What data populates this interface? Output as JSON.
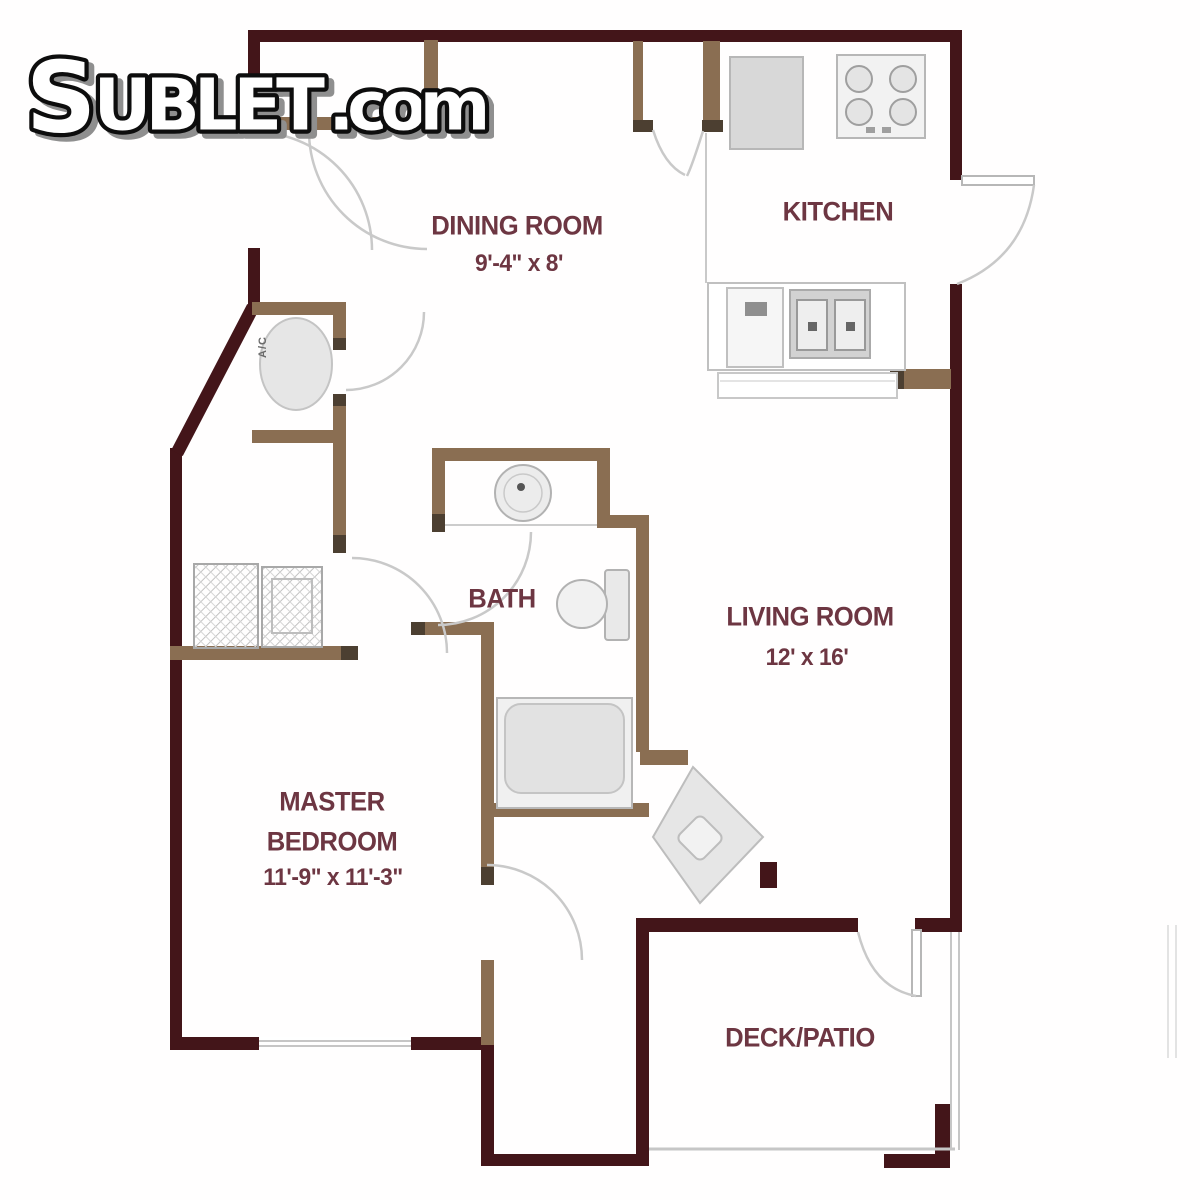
{
  "logo": {
    "s": "S",
    "ublet": "UBLET",
    "dotcom": ".com",
    "full_text": "SUBLET.com"
  },
  "rooms": {
    "dining": {
      "name": "DINING ROOM",
      "dims": "9'-4\" x 8'"
    },
    "kitchen": {
      "name": "KITCHEN"
    },
    "bath": {
      "name": "BATH"
    },
    "living": {
      "name": "LIVING ROOM",
      "dims": "12' x 16'"
    },
    "master": {
      "line1": "MASTER",
      "line2": "BEDROOM",
      "dims": "11'-9\" x 11'-3\""
    },
    "deck": {
      "name": "DECK/PATIO"
    },
    "utility": {
      "label": "A/C"
    }
  },
  "colors": {
    "wall_dark": "#431519",
    "wall_brown": "#8a6e52",
    "wall_cap": "#4c3f31",
    "fixture_line": "#b7b7b7",
    "arc_line": "#c9c9c9",
    "label_text": "#6d3642",
    "logo_outline": "#0d0d0d",
    "logo_fill": "#ffffff",
    "logo_shadow": "#8f8f8f"
  }
}
